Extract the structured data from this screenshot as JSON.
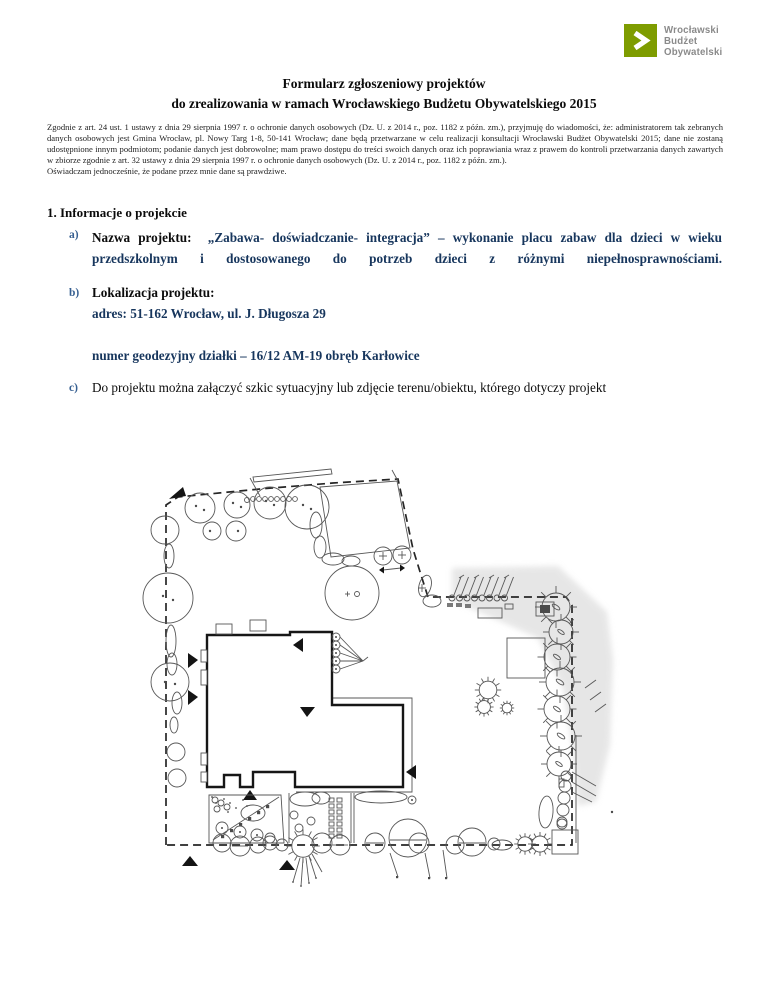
{
  "logo": {
    "brand_lines": [
      "Wrocławski",
      "Budżet",
      "Obywatelski"
    ],
    "box_color": "#7E9C00",
    "text_color": "#8A8A8A",
    "chevron_icon": "chevron-right"
  },
  "header": {
    "title_line1": "Formularz zgłoszeniowy projektów",
    "title_line2": "do zrealizowania w ramach Wrocławskiego Budżetu Obywatelskiego 2015"
  },
  "legal": {
    "body": "Zgodnie z art. 24 ust. 1 ustawy z dnia 29 sierpnia 1997 r. o ochronie danych osobowych (Dz. U. z 2014 r., poz. 1182 z późn. zm.), przyjmuję do wiadomości, że: administratorem tak zebranych danych osobowych jest Gmina Wrocław, pl. Nowy Targ 1-8, 50-141 Wrocław; dane będą przetwarzane w celu realizacji konsultacji Wrocławski Budżet Obywatelski 2015; dane nie zostaną udostępnione innym podmiotom; podanie danych jest dobrowolne; mam prawo dostępu do treści swoich danych oraz ich poprawiania wraz z prawem do kontroli przetwarzania danych zawartych w zbiorze zgodnie z art. 32 ustawy z dnia 29 sierpnia 1997 r. o ochronie danych osobowych (Dz. U. z 2014 r., poz. 1182 z późn. zm.).",
    "declaration": "Oświadczam jednocześnie, że podane przez mnie dane są prawdziwe."
  },
  "section1": {
    "heading": "1. Informacje o projekcie",
    "item_a": {
      "marker": "a)",
      "label": "Nazwa projektu:",
      "value": "„Zabawa- doświadczanie- integracja” – wykonanie placu zabaw dla dzieci w wieku przedszkolnym i dostosowanego do potrzeb dzieci z różnymi niepełnosprawnościami."
    },
    "item_b": {
      "marker": "b)",
      "label": "Lokalizacja projektu:",
      "address": "adres: 51-162 Wrocław, ul. J. Długosza 29",
      "plot": "numer geodezyjny działki – 16/12 AM-19 obręb Karłowice"
    },
    "item_c": {
      "marker": "c)",
      "text": "Do projektu można załączyć szkic sytuacyjny lub zdjęcie terenu/obiektu, którego dotyczy projekt"
    }
  },
  "figure": {
    "alt": "szkic sytuacyjny terenu"
  },
  "colors": {
    "value_navy": "#17365D",
    "marker_blue": "#365F91",
    "logo_green": "#7E9C00"
  }
}
